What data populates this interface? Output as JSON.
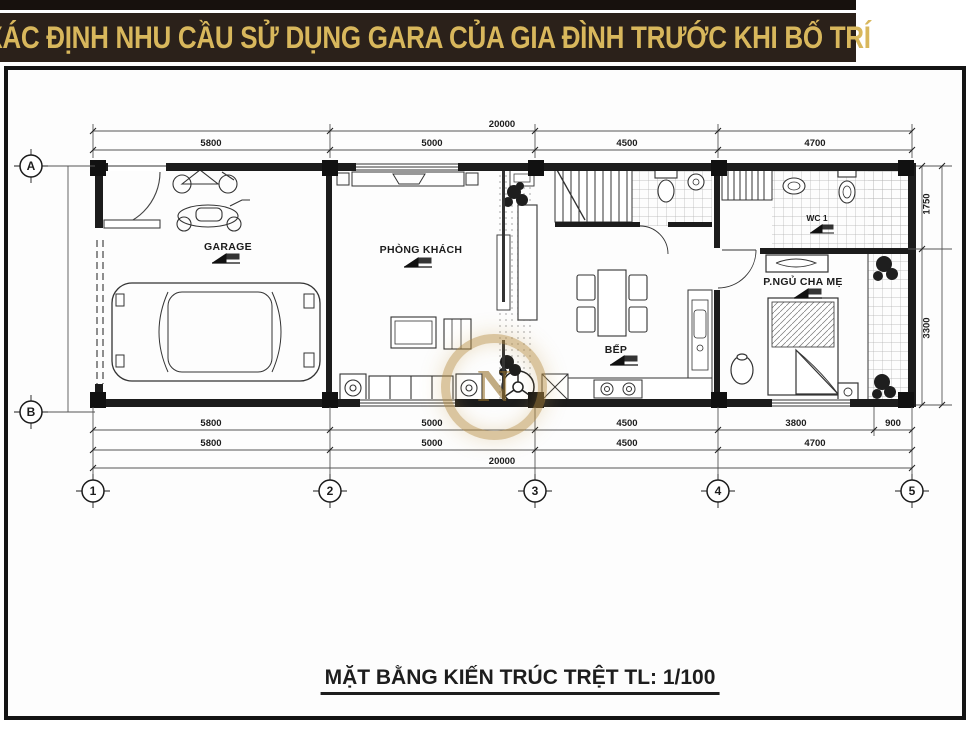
{
  "banner": {
    "title": "XÁC ĐỊNH NHU CẦU SỬ DỤNG GARA CỦA GIA ĐÌNH TRƯỚC KHI BỐ TRÍ",
    "bg_color": "#2b211a",
    "text_color": "#d8b75c"
  },
  "caption": {
    "text": "MẶT BẰNG KIẾN TRÚC TRỆT TL: 1/100"
  },
  "rooms": {
    "garage": "GARAGE",
    "living": "PHÒNG KHÁCH",
    "kitchen": "BẾP",
    "bedroom": "P.NGỦ CHA MẸ",
    "wc1": "WC 1"
  },
  "grid": {
    "rows": [
      "A",
      "B"
    ],
    "cols": [
      "1",
      "2",
      "3",
      "4",
      "5"
    ]
  },
  "dims": {
    "top_total": "20000",
    "top_segments": [
      "5800",
      "5000",
      "4500",
      "4700"
    ],
    "bottom_row1": [
      "5800",
      "5000",
      "4500",
      "3800",
      "900"
    ],
    "bottom_row2": [
      "5800",
      "5000",
      "4500",
      "4700"
    ],
    "bottom_total": "20000",
    "right_segments": [
      "1750",
      "3300"
    ]
  },
  "watermark": {
    "letter": "N",
    "color": "#b78d42"
  }
}
